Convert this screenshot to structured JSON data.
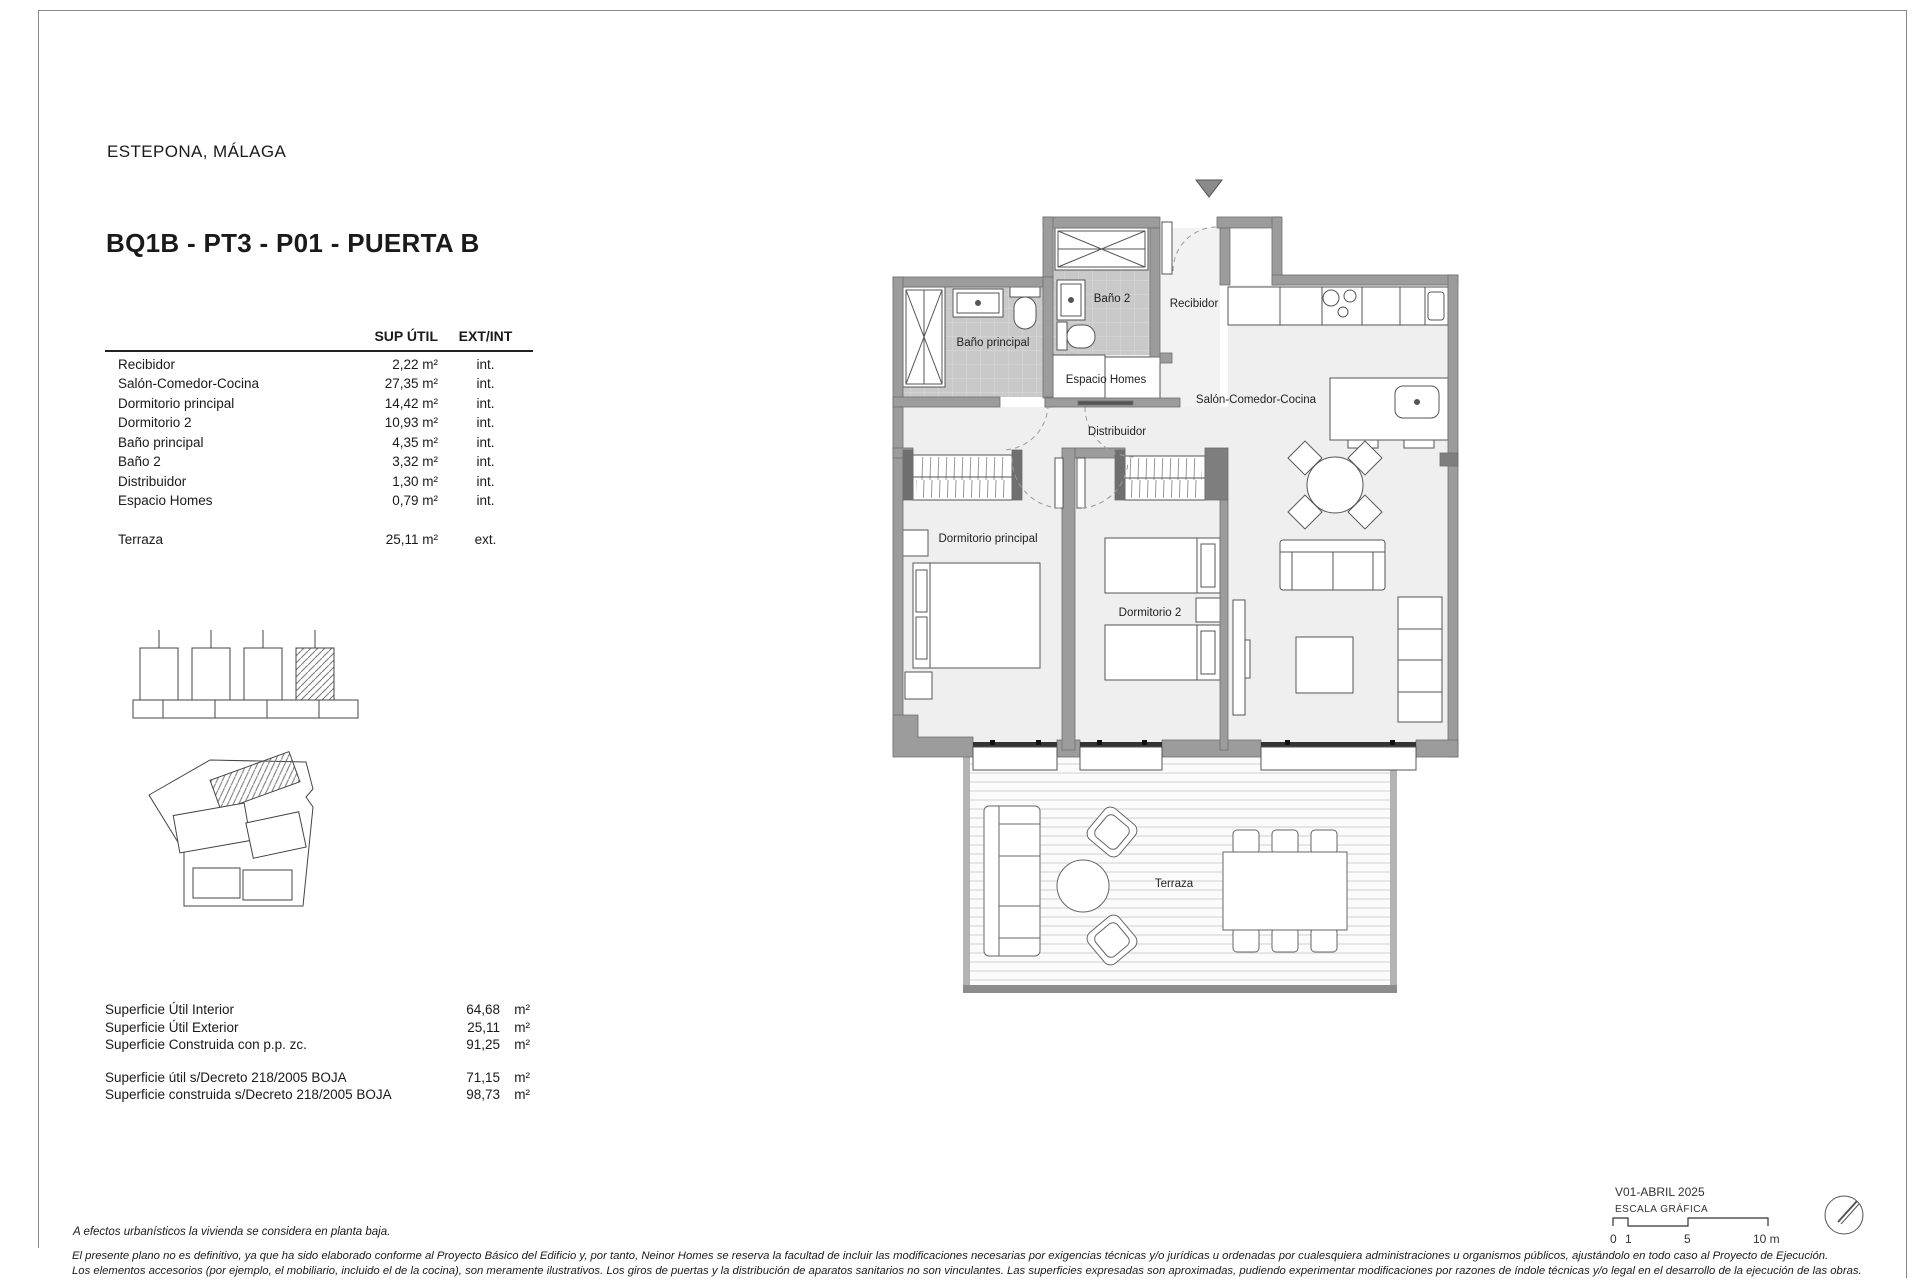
{
  "header": {
    "location": "ESTEPONA, MÁLAGA",
    "unit_title": "BQ1B - PT3 - P01 - PUERTA B"
  },
  "areas_table": {
    "header": {
      "sup": "SUP ÚTIL",
      "extint": "EXT/INT"
    },
    "rows": [
      {
        "label": "Recibidor",
        "sup": "2,22 m²",
        "type": "int."
      },
      {
        "label": "Salón-Comedor-Cocina",
        "sup": "27,35 m²",
        "type": "int."
      },
      {
        "label": "Dormitorio principal",
        "sup": "14,42 m²",
        "type": "int."
      },
      {
        "label": "Dormitorio 2",
        "sup": "10,93 m²",
        "type": "int."
      },
      {
        "label": "Baño principal",
        "sup": "4,35 m²",
        "type": "int."
      },
      {
        "label": "Baño 2",
        "sup": "3,32 m²",
        "type": "int."
      },
      {
        "label": "Distribuidor",
        "sup": "1,30 m²",
        "type": "int."
      },
      {
        "label": "Espacio Homes",
        "sup": "0,79 m²",
        "type": "int."
      }
    ],
    "terrace_row": {
      "label": "Terraza",
      "sup": "25,11 m²",
      "type": "ext."
    }
  },
  "summary": {
    "group1": [
      {
        "label": "Superficie Útil Interior",
        "value": "64,68",
        "unit": "m²"
      },
      {
        "label": "Superficie Útil Exterior",
        "value": "25,11",
        "unit": "m²"
      },
      {
        "label": "Superficie Construida con p.p. zc.",
        "value": "91,25",
        "unit": "m²"
      }
    ],
    "group2": [
      {
        "label": "Superficie útil s/Decreto 218/2005 BOJA",
        "value": "71,15",
        "unit": "m²"
      },
      {
        "label": "Superficie construida s/Decreto 218/2005 BOJA",
        "value": "98,73",
        "unit": "m²"
      }
    ]
  },
  "plan": {
    "room_labels": {
      "bano_principal": "Baño principal",
      "bano2": "Baño 2",
      "recibidor": "Recibidor",
      "espacio_homes": "Espacio Homes",
      "distribuidor": "Distribuidor",
      "salon": "Salón-Comedor-Cocina",
      "dormitorio_principal": "Dormitorio principal",
      "dormitorio2": "Dormitorio 2",
      "terraza": "Terraza"
    }
  },
  "titleblock": {
    "version": "V01-ABRIL 2025",
    "scale_label": "ESCALA GRÁFICA",
    "tick0": "0",
    "tick1": "1",
    "tick5": "5",
    "tick10": "10 m"
  },
  "notes": {
    "planta_baja": "A efectos urbanísticos la vivienda se considera en planta baja.",
    "disclaimer1": "El presente plano no es definitivo, ya que ha sido elaborado conforme al Proyecto Básico del Edificio y, por tanto, Neinor Homes se reserva la facultad de incluir las modificaciones necesarias por exigencias técnicas y/o jurídicas u ordenadas por cualesquiera administraciones u organismos públicos, ajustándolo en todo caso al Proyecto de Ejecución.",
    "disclaimer2": "Los elementos accesorios (por ejemplo, el mobiliario, incluido el de la cocina), son meramente ilustrativos. Los giros de puertas y la distribución de aparatos sanitarios no son vinculantes. Las superficies expresadas son aproximadas, pudiendo experimentar modificaciones por razones de índole técnicas y/o legal en el desarrollo de la ejecución de las obras."
  },
  "colors": {
    "wall": "#9c9c9c",
    "tile": "#c9c9c9",
    "floor": "#efefef",
    "marker": "#8a8a8a"
  }
}
